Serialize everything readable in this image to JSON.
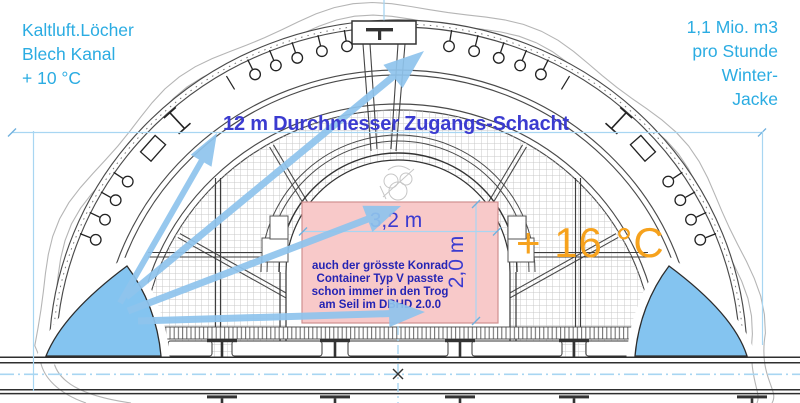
{
  "labels": {
    "cold_air": {
      "line1": "Kaltluft.Löcher",
      "line2": "Blech Kanal",
      "line3": "+ 10 °C"
    },
    "air_volume": {
      "line1": "1,1 Mio. m3",
      "line2": "pro Stunde",
      "line3": "Winter-",
      "line4": "Jacke"
    },
    "shaft_title": "12 m Durchmesser Zugangs-Schacht",
    "temperature_inside": "+ 16 °C",
    "width_dim": "3,2 m",
    "height_dim": "2,0 m",
    "container_note": {
      "line1": "auch der grösste Konrad",
      "line2": "Container Typ V passte",
      "line3": "schon immer in den Trog",
      "line4": "am Seil im DBHD 2.0.0"
    }
  },
  "colors": {
    "cyan_text": "#2BACE2",
    "dim_blue": "#3B3BD0",
    "note_blue": "#2424B4",
    "orange": "#F6A21D",
    "pink_fill": "#F8C9C9",
    "pink_border": "#CF8F8F",
    "arrow_blue": "#8FC4ED",
    "wedge_blue": "#84C4F0",
    "guide_cyan": "#A8D6F2",
    "line_dark": "#3D3D3D",
    "grid_line": "#C9C9C9"
  },
  "icons": [
    "anchor-hook-icon",
    "i-beam-icon",
    "h-beam-icon",
    "center-cross-icon",
    "shaft-turret-icon",
    "hoist-sketch-icon"
  ]
}
